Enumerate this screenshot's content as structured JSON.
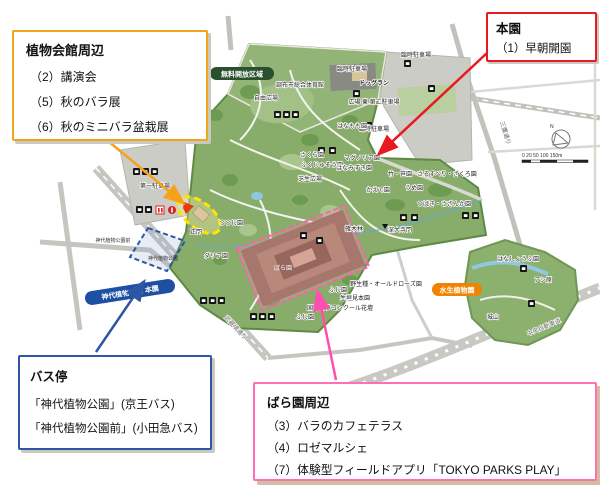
{
  "callouts": {
    "hall": {
      "title": "植物会館周辺",
      "items": [
        "（2）講演会",
        "（5）秋のバラ展",
        "（6）秋のミニバラ盆栽展"
      ]
    },
    "main": {
      "title": "本園",
      "items": [
        "（1）早朝開園"
      ]
    },
    "bus": {
      "title": "バス停",
      "items": [
        "「神代植物公園」(京王バス)",
        "「神代植物公園前」(小田急バス)"
      ]
    },
    "rose": {
      "title": "ばら園周辺",
      "items": [
        "（3）バラのカフェテラス",
        "（4）ロゼマルシェ",
        "（7）体験型フィールドアプリ「TOKYO PARKS PLAY」"
      ]
    }
  },
  "map": {
    "colors": {
      "hall_accent": "#efa51e",
      "main_accent": "#e8191f",
      "bus_accent": "#2e56a5",
      "rose_accent": "#ff6eb7",
      "park_green": "#88ad6a",
      "aquatic_pill": "#f08300",
      "honen_pill": "#1d50a2",
      "free_zone_pill": "#29512e"
    },
    "labels": {
      "free_zone": "無料開放区域",
      "gym": "調布市総合体育館",
      "free_plaza": "自由広場",
      "temp_parking_a": "臨時駐車場",
      "temp_parking_b": "臨時駐車場",
      "temp_parking_c": "臨時駐車場",
      "dog_run": "ドッグラン",
      "plaza_east_p2": "広場 東 第二駐車場",
      "parking1": "第一駐車場",
      "main_gate": "正門",
      "tsutsuji": "つつじ園",
      "lawn_plaza": "芝生広場",
      "hanamomo": "はなもも園",
      "sakura": "さくら園",
      "fukujuso": "ふくじゅそう園",
      "magnolia": "マグノリア園",
      "hanamizuki": "はなみずき園",
      "take_sasa": "竹・笹園",
      "sarusuberi": "さるすべり・ざくろ園",
      "ume": "うめ園",
      "tsubaki": "つばき・さざんか園",
      "kaede": "かえで園",
      "zokibayashi": "雑木林",
      "jindaiji_gate": "深大寺門",
      "dahlia": "ダリア園",
      "rose": "ばら園",
      "wild_rose": "野生種・オールドローズ園",
      "fuji_a": "ふじ園",
      "fuji_b": "ふじ園",
      "ikegaki": "生垣見本園",
      "rose_concours": "国際バラコンクール花壇",
      "aquatic": "水生植物園",
      "hanashobu": "はなしょうぶ園",
      "ashihara": "アシ原",
      "shiroyama": "城山",
      "honen_pill": "神代植物公園 本園",
      "busstop_mae": "神代植物公園前",
      "busstop_jindai": "神代植物公園",
      "road_musashisakai": "武蔵境通り",
      "road_mitaka": "三鷹通り",
      "road_chuo": "中央自動車道",
      "compass_n": "N",
      "scale": "0 20 50   100     150m"
    }
  }
}
